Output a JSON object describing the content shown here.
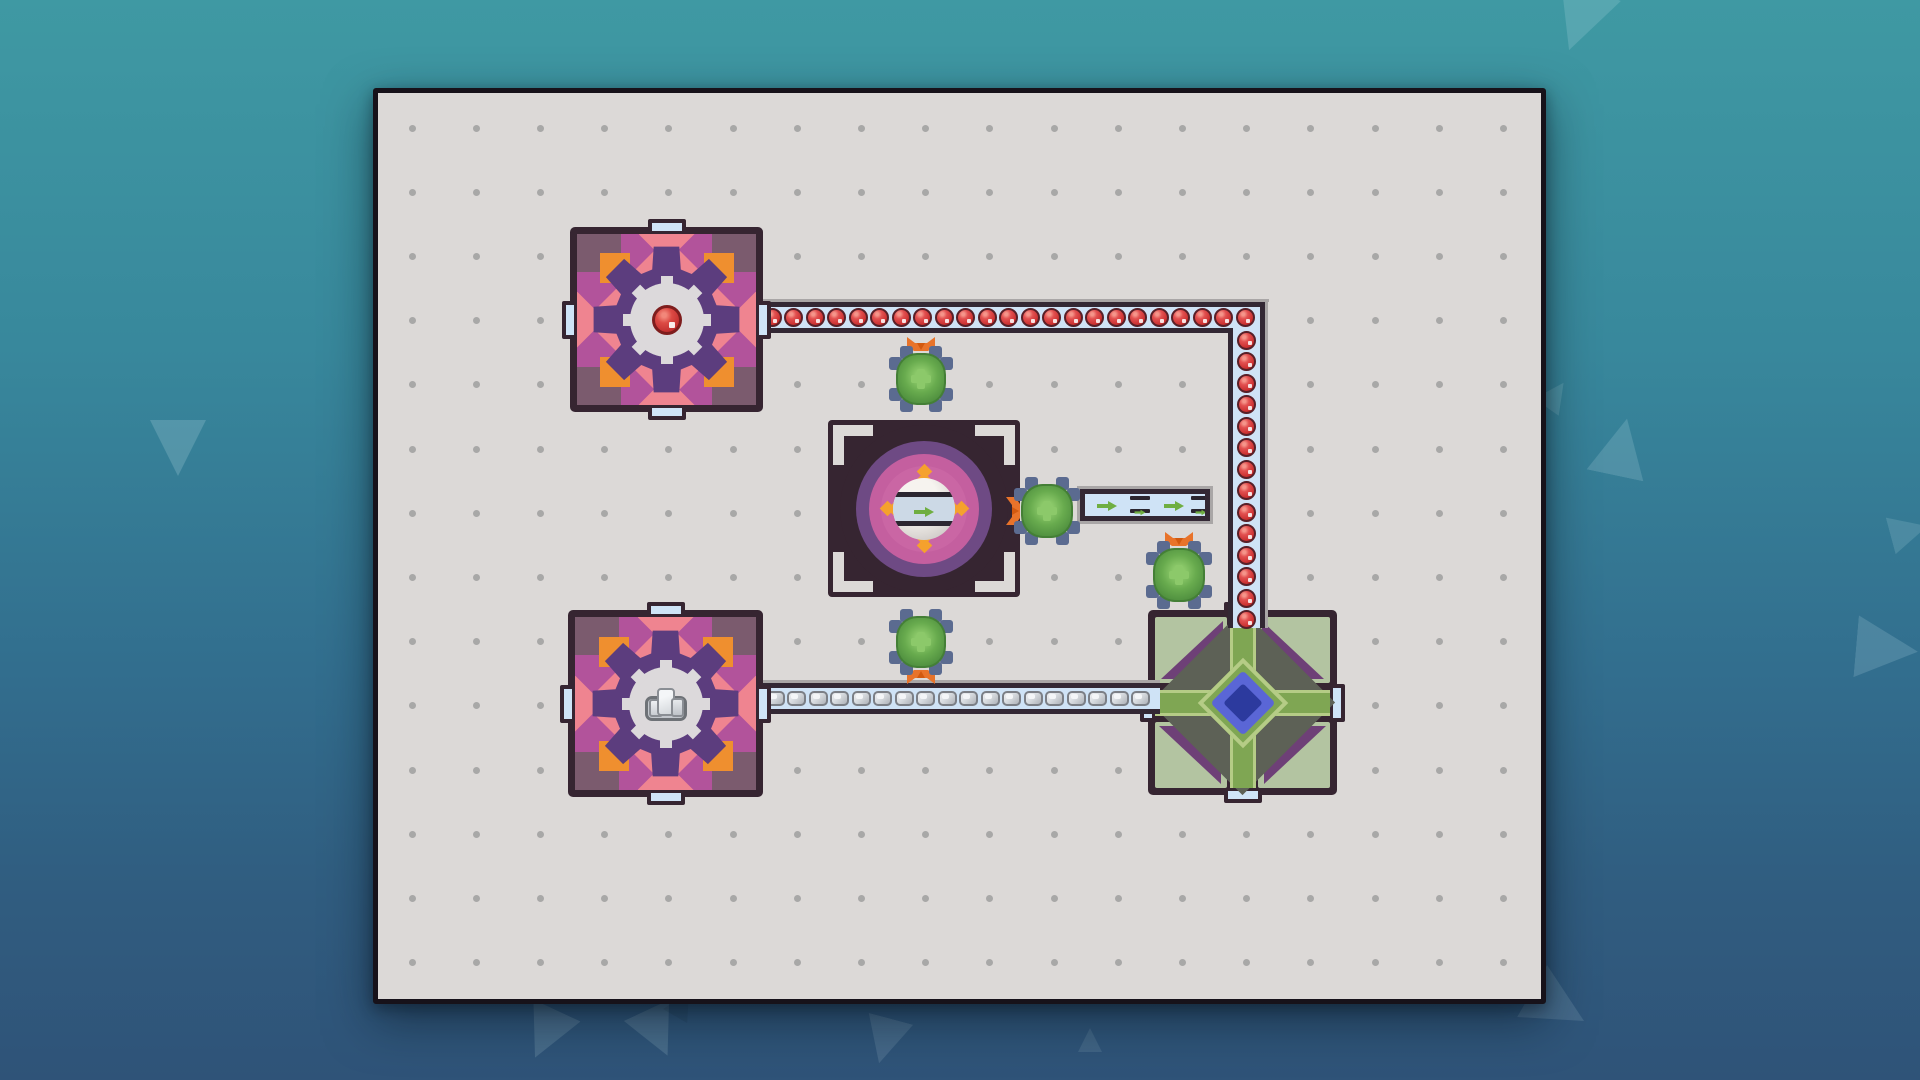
{
  "scene": {
    "title": "factory-grid-puzzle",
    "colors": {
      "bg_top": "#3f99a3",
      "bg_bottom": "#2f5378",
      "board_bg": "#dcd9d7",
      "board_border": "#17121a",
      "grid_dot": "#9b9b9b",
      "belt_fill": "#cfe3f6",
      "belt_border": "#332834",
      "belt_shadow": "#a9a6a6",
      "orb_red": "#c92f2f",
      "stone_gray": "#d7dbdf",
      "extractor_dark": "#362531",
      "extractor_body": "#b2539b",
      "extractor_corner": "#7b5b6e",
      "salmon": "#ef8490",
      "orange": "#ef8f2f",
      "star_purple": "#5c3d7e",
      "center_gray": "#dcd9db",
      "machine_purple": "#6e4a84",
      "machine_magenta": "#c45f9f",
      "machine_orange": "#f5a12d",
      "machine_ball": "#e7e3df",
      "machine_bar": "#2b2630",
      "machine_band": "#ccd9e6",
      "arrow_green": "#6fae41",
      "hub_sage": "#b3c4a1",
      "hub_cyan": "#49b5e9",
      "hub_purple": "#6e4077",
      "hub_body": "#5d6156",
      "hub_green": "#7fa653",
      "hub_green_light": "#b5cc86",
      "hub_blue": "#5a66d6",
      "hub_navy": "#2c3a9e",
      "port_fill": "#cfe4f7",
      "port_top_fill": "#eef2f8",
      "bug_body": "#68ab4e",
      "bug_light": "#8cc96a",
      "bug_dark": "#447f36",
      "bug_legs": "#5b6b90",
      "claw_orange": "#e8732a",
      "claw_dark": "#d2590f"
    }
  },
  "board": {
    "x": 373,
    "y": 88,
    "w": 1163,
    "h": 906,
    "grid": {
      "cols": 18,
      "rows": 14,
      "ox": 34,
      "oy": 35,
      "dx": 64.2,
      "dy": 64.2,
      "dot_size": 7
    }
  },
  "belts": [
    {
      "id": "belt-red-vertical",
      "dir": "v",
      "x": 1228,
      "y": 302,
      "w": 37,
      "h": 326,
      "cargo": "red-orb",
      "count": 14,
      "start": 38,
      "step": 21.5
    },
    {
      "id": "belt-red-horizontal",
      "dir": "h",
      "x": 758,
      "y": 302,
      "w": 502,
      "h": 31,
      "cargo": "red-orb",
      "count": 23,
      "start": 14,
      "step": 21.5
    },
    {
      "id": "belt-stone",
      "dir": "h",
      "x": 758,
      "y": 683,
      "w": 402,
      "h": 31,
      "cargo": "stone",
      "count": 18,
      "start": 17,
      "step": 21.5
    },
    {
      "id": "belt-output",
      "dir": "free",
      "x": 1080,
      "y": 489,
      "w": 130,
      "h": 32,
      "cargo": "conveyor-parts",
      "items": [
        "arrow",
        "belt-item",
        "arrow",
        "belt-item"
      ],
      "item_centers": [
        27,
        60,
        94,
        121
      ]
    }
  ],
  "buildings": [
    {
      "id": "extractor-red",
      "type": "extractor",
      "resource": "red-orb",
      "x": 570,
      "y": 227,
      "w": 193,
      "h": 185
    },
    {
      "id": "extractor-stone",
      "type": "extractor",
      "resource": "stone",
      "x": 568,
      "y": 610,
      "w": 195,
      "h": 187
    },
    {
      "id": "assembler",
      "type": "assembler",
      "product": "conveyor-belt",
      "x": 828,
      "y": 420,
      "w": 192,
      "h": 177
    },
    {
      "id": "hub",
      "type": "hub",
      "x": 1148,
      "y": 610,
      "w": 189,
      "h": 185
    }
  ],
  "bugs": [
    {
      "id": "bug-north",
      "x": 896,
      "y": 353,
      "w": 50,
      "h": 52,
      "claw": "up"
    },
    {
      "id": "bug-east",
      "x": 1021,
      "y": 484,
      "w": 52,
      "h": 54,
      "claw": "left"
    },
    {
      "id": "bug-hub",
      "x": 1153,
      "y": 548,
      "w": 52,
      "h": 54,
      "claw": "up"
    },
    {
      "id": "bug-south",
      "x": 896,
      "y": 616,
      "w": 50,
      "h": 52,
      "claw": "down"
    }
  ],
  "decor_triangles": [
    {
      "x": 1548,
      "y": -12,
      "s": 64,
      "r": 200,
      "o": 0.16
    },
    {
      "x": 1540,
      "y": 380,
      "s": 30,
      "r": 35,
      "o": 0.14
    },
    {
      "x": 1592,
      "y": 418,
      "s": 58,
      "r": 12,
      "o": 0.16
    },
    {
      "x": 150,
      "y": 420,
      "s": 56,
      "r": 180,
      "o": 0.18
    },
    {
      "x": 520,
      "y": 1008,
      "s": 52,
      "r": 205,
      "o": 0.14
    },
    {
      "x": 632,
      "y": 1008,
      "s": 50,
      "r": 155,
      "o": 0.14
    },
    {
      "x": 668,
      "y": 990,
      "s": 28,
      "r": 30,
      "o": 0.1,
      "dark": true
    },
    {
      "x": 862,
      "y": 1018,
      "s": 46,
      "r": 195,
      "o": 0.12
    },
    {
      "x": 1078,
      "y": 1028,
      "s": 24,
      "r": 0,
      "o": 0.1
    },
    {
      "x": 1856,
      "y": 618,
      "s": 62,
      "r": 95,
      "o": 0.16
    },
    {
      "x": 1890,
      "y": 512,
      "s": 38,
      "r": 75,
      "o": 0.14
    },
    {
      "x": 1528,
      "y": 976,
      "s": 60,
      "r": 120,
      "o": 0.12
    }
  ]
}
